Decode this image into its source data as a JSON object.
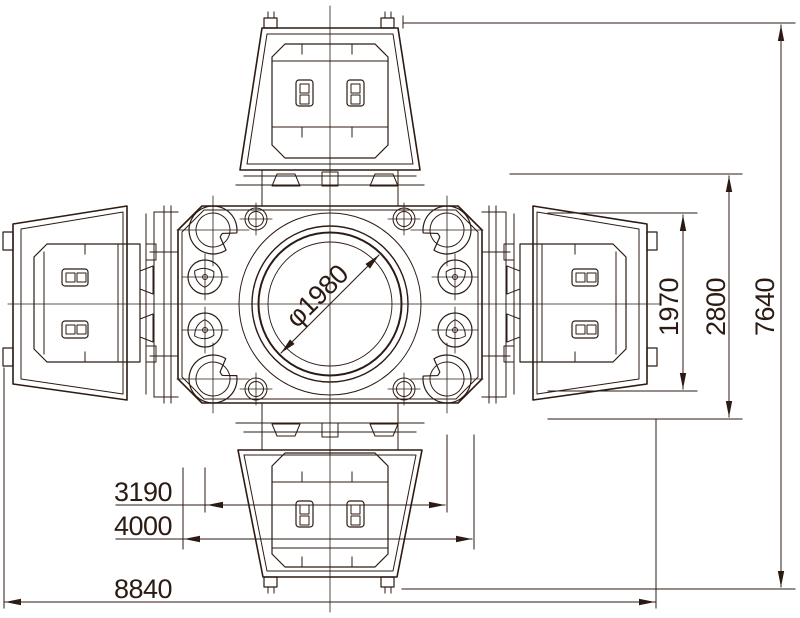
{
  "drawing": {
    "description": "Plan-view technical drawing of a four-station machine",
    "colors": {
      "line": "#2c1b13",
      "background": "#ffffff"
    },
    "dimensions": {
      "bore_diameter": "φ1980",
      "bottom_inner_width": "3190",
      "bottom_mid_width": "4000",
      "bottom_overall_width": "8840",
      "right_inner_height": "1970",
      "right_mid_height": "2800",
      "right_overall_height": "7640"
    }
  }
}
